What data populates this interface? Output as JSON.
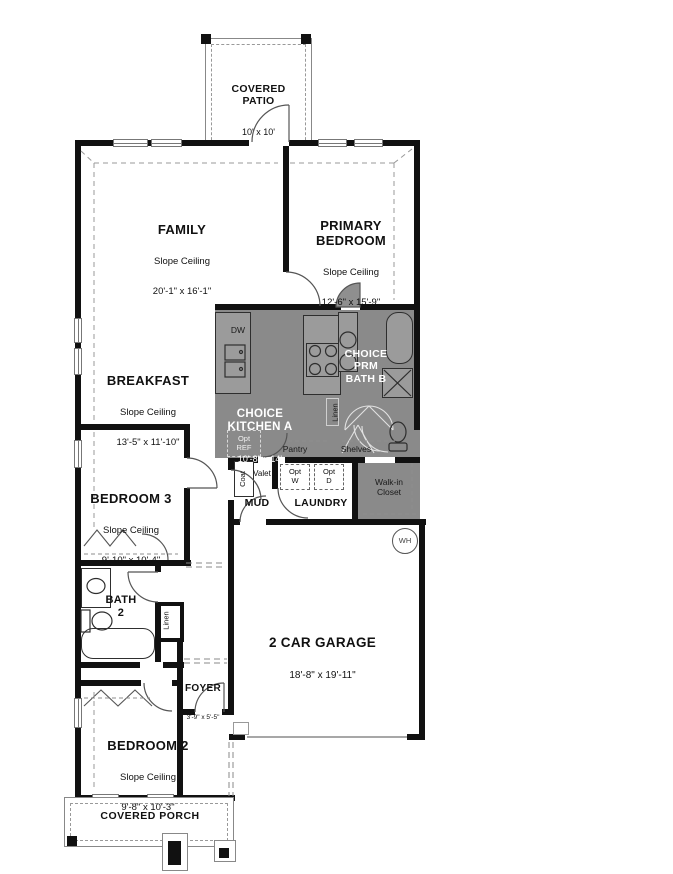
{
  "colors": {
    "wall": "#111111",
    "core_gray": "#8a8a8a",
    "counter_gray": "#9b9b9b",
    "dash": "#999999",
    "text_dark": "#111111",
    "text_light": "#ffffff"
  },
  "rooms": {
    "patio": {
      "name": "COVERED\nPATIO",
      "dims": "10' x 10'"
    },
    "family": {
      "name": "FAMILY",
      "ceiling": "Slope Ceiling",
      "dims": "20'-1\" x 16'-1\""
    },
    "primary": {
      "name": "PRIMARY\nBEDROOM",
      "ceiling": "Slope Ceiling",
      "dims": "12'-6\" x 15'-9\""
    },
    "breakfast": {
      "name": "BREAKFAST",
      "ceiling": "Slope Ceiling",
      "dims": "13'-5\" x 11'-10\""
    },
    "kitchen": {
      "name": "CHOICE\nKITCHEN A",
      "dims": "10'-8\" x 14'"
    },
    "prm_bath": {
      "name": "CHOICE\nPRM\nBATH B"
    },
    "bedroom3": {
      "name": "BEDROOM 3",
      "ceiling": "Slope Ceiling",
      "dims": "9'-10\" x 10'-4\""
    },
    "bath2": {
      "name": "BATH\n2"
    },
    "mud": {
      "name": "MUD"
    },
    "laundry": {
      "name": "LAUNDRY"
    },
    "walkin": {
      "name": "Walk-in\nCloset"
    },
    "garage": {
      "name": "2 CAR GARAGE",
      "dims": "18'-8\" x 19'-11\""
    },
    "foyer": {
      "name": "FOYER",
      "dims": "3'-9\" x 5'-5\""
    },
    "bedroom2": {
      "name": "BEDROOM 2",
      "ceiling": "Slope Ceiling",
      "dims": "9'-8\" x 10'-3\""
    },
    "porch": {
      "name": "COVERED PORCH"
    }
  },
  "features": {
    "dw": "DW",
    "opt_ref": "Opt\nREF",
    "pantry": "Pantry",
    "shelves": "Shelves",
    "linen_bath": "Linen",
    "linen_hall": "Linen",
    "coat": "Coat",
    "valet": "Valet",
    "opt_washer": "Opt\nW",
    "opt_dryer": "Opt\nD",
    "water_heater": "WH"
  }
}
